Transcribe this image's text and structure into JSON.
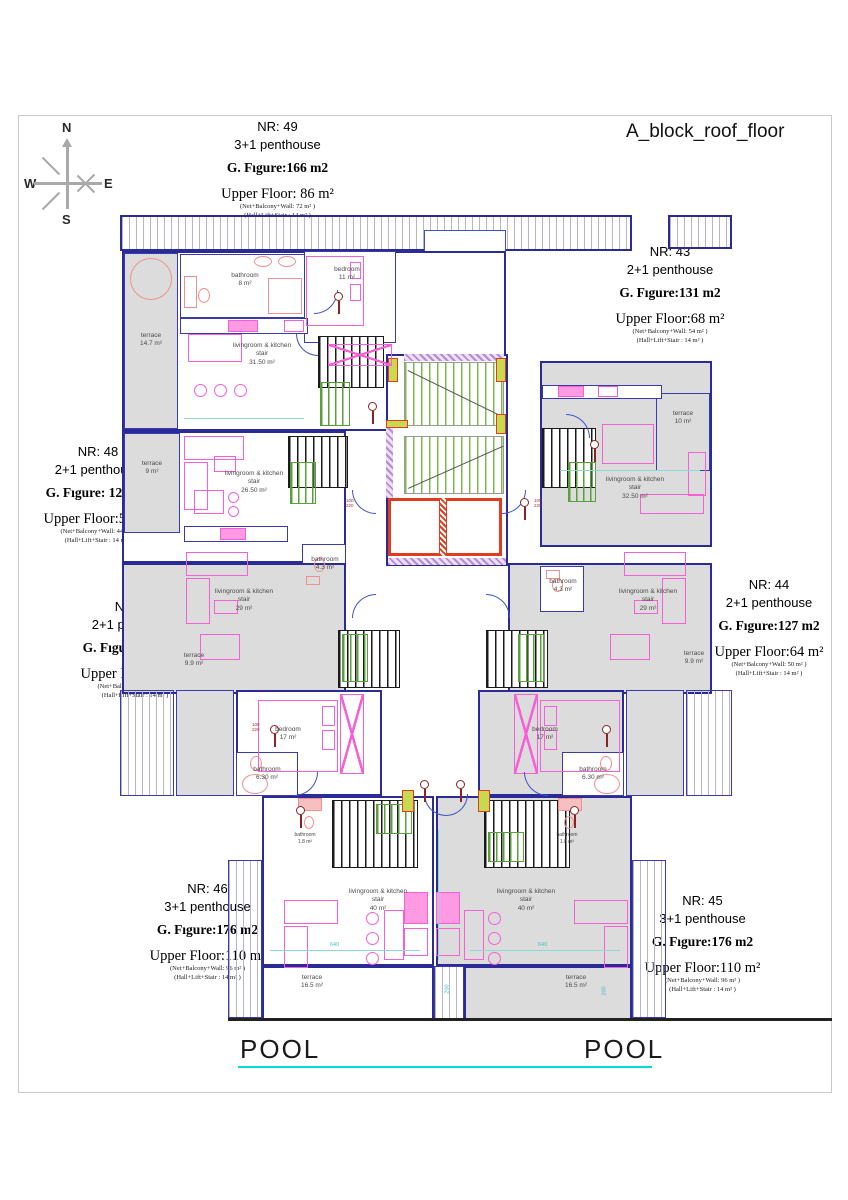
{
  "sheet": {
    "title": "A_block_roof_floor"
  },
  "compass": {
    "north": "N",
    "east": "E",
    "south": "S",
    "west": "W"
  },
  "pool": {
    "left_label": "POOL",
    "right_label": "POOL"
  },
  "apartments": [
    {
      "nr": "NR: 49",
      "type": "3+1 penthouse",
      "figure": "G. Fıgure:166 m2",
      "upper_floor": "Upper Floor: 86 m²",
      "detail_net": "(Net+Balcony+Wall: 72 m² )",
      "detail_hall": "(Hall+Lift+Stair : 14 m² )"
    },
    {
      "nr": "NR: 43",
      "type": "2+1 penthouse",
      "figure": "G. Fıgure:131 m2",
      "upper_floor": "Upper Floor:68 m²",
      "detail_net": "(Net+Balcony+Wall: 54 m² )",
      "detail_hall": "(Hall+Lift+Stair : 14 m² )"
    },
    {
      "nr": "NR: 48",
      "type": "2+1 penthouse",
      "figure": "G. Fıgure: 121 m2",
      "upper_floor": "Upper Floor:58 m²",
      "detail_net": "(Net+Balcony+Wall: 44 m² )",
      "detail_hall": "(Hall+Lift+Stair : 14 m² )"
    },
    {
      "nr": "NR: 47",
      "type": "2+1 penthouse",
      "figure": "G. Fıgure: 127 m2",
      "upper_floor": "Upper Floor:64 m²",
      "detail_net": "(Net+Balcony+Wall: 50 m² )",
      "detail_hall": "(Hall+Lift+Stair : 14 m² )"
    },
    {
      "nr": "NR: 44",
      "type": "2+1 penthouse",
      "figure": "G. Fıgure:127 m2",
      "upper_floor": "Upper Floor:64 m²",
      "detail_net": "(Net+Balcony+Wall: 50 m² )",
      "detail_hall": "(Hall+Lift+Stair : 14 m² )"
    },
    {
      "nr": "NR: 46",
      "type": "3+1 penthouse",
      "figure": "G. Fıgure:176 m2",
      "upper_floor": "Upper Floor:110 m²",
      "detail_net": "(Net+Balcony+Wall: 96 m² )",
      "detail_hall": "(Hall+Lift+Stair : 14 m² )"
    },
    {
      "nr": "NR: 45",
      "type": "3+1 penthouse",
      "figure": "G. Fıgure:176 m2",
      "upper_floor": "Upper Floor:110 m²",
      "detail_net": "(Net+Balcony+Wall: 96 m² )",
      "detail_hall": "(Hall+Lift+Stair : 14 m² )"
    }
  ],
  "rooms": [
    {
      "l1": "terrace",
      "l2": "14.7 m²"
    },
    {
      "l1": "bathroom",
      "l2": "8 m²"
    },
    {
      "l1": "bedroom",
      "l2": "11 m²"
    },
    {
      "l1": "livingroom & kitchen",
      "l2": "stair",
      "l3": "31.50 m²"
    },
    {
      "l1": "terrace",
      "l2": "9 m²"
    },
    {
      "l1": "livingroom & kitchen",
      "l2": "stair",
      "l3": "26.50 m²"
    },
    {
      "l1": "bathroom",
      "l2": "4.3 m²"
    },
    {
      "l1": "livingroom & kitchen",
      "l2": "stair",
      "l3": "29 m²"
    },
    {
      "l1": "terrace",
      "l2": "9.9 m²"
    },
    {
      "l1": "terrace",
      "l2": "10 m²"
    },
    {
      "l1": "livingroom & kitchen",
      "l2": "stair",
      "l3": "32.50 m²"
    },
    {
      "l1": "bathroom",
      "l2": "4.3 m²"
    },
    {
      "l1": "livingroom & kitchen",
      "l2": "stair",
      "l3": "29 m²"
    },
    {
      "l1": "terrace",
      "l2": "9.9 m²"
    },
    {
      "l1": "bedroom",
      "l2": "17 m²"
    },
    {
      "l1": "bathroom",
      "l2": "6.30 m²"
    },
    {
      "l1": "bedroom",
      "l2": "17 m²"
    },
    {
      "l1": "bathroom",
      "l2": "6.30 m²"
    },
    {
      "l1": "livingroom & kitchen",
      "l2": "stair",
      "l3": "40 m²"
    },
    {
      "l1": "livingroom & kitchen",
      "l2": "stair",
      "l3": "40 m²"
    },
    {
      "l1": "terrace",
      "l2": "16.5 m²"
    },
    {
      "l1": "terrace",
      "l2": "16.5 m²"
    },
    {
      "l1": "bathroom",
      "l2": "1.8 m²"
    },
    {
      "l1": "bathroom",
      "l2": "1.8 m²"
    }
  ],
  "dims": {
    "d1": "640",
    "d2": "640",
    "d3": "200",
    "d4": "200",
    "door_tag": "100\n220"
  },
  "colors": {
    "wall": "#2b2b97",
    "terrace_fill": "#dcdcdc",
    "furniture": "#f75fd7",
    "stair_green": "#58a13a",
    "elevator_red": "#e23c1e",
    "dim_cyan": "#49bcbc",
    "pool_line": "#00dcdc"
  }
}
